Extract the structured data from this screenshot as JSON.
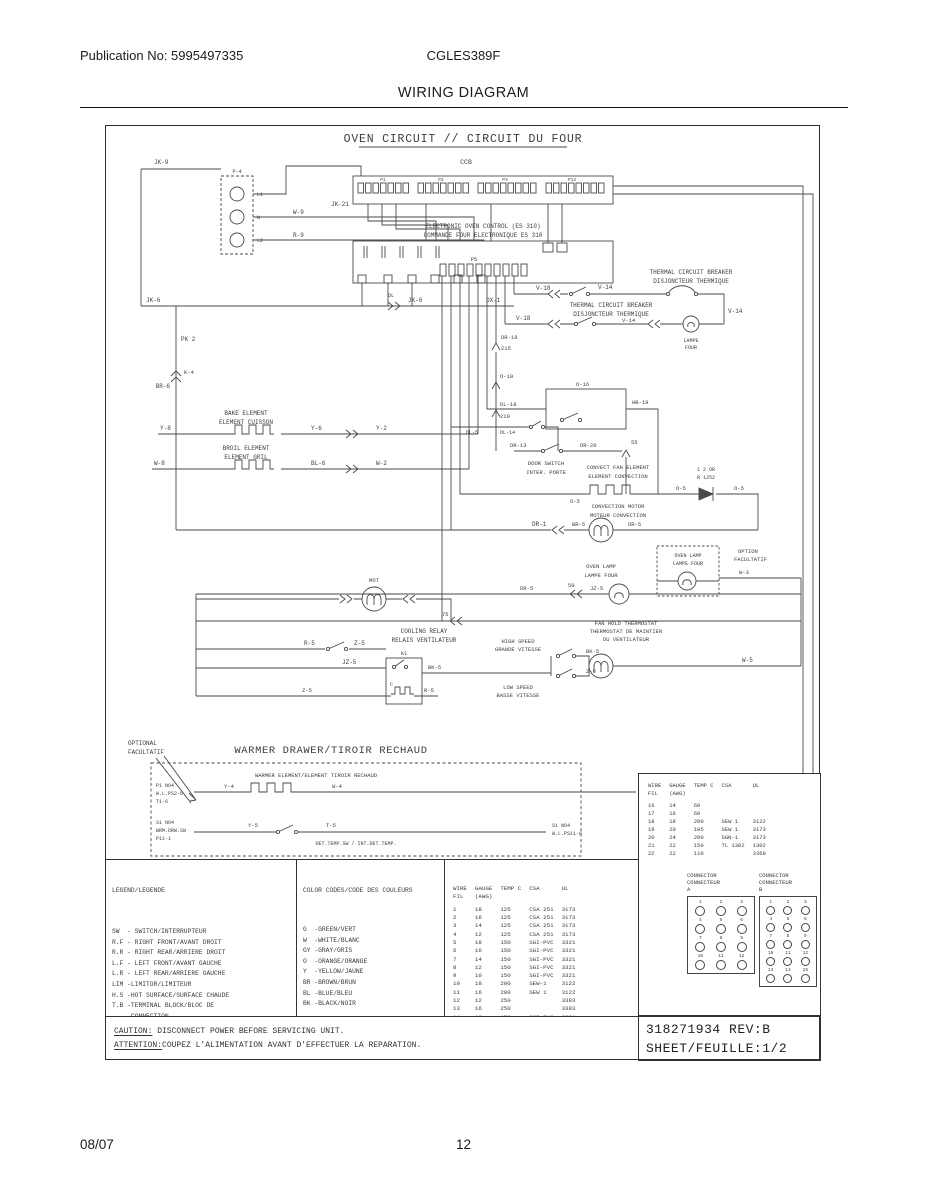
{
  "page": {
    "publication": "Publication No: 5995497335",
    "model": "CGLES389F",
    "title": "WIRING DIAGRAM",
    "date": "08/07",
    "page_number": "12"
  },
  "diagram": {
    "title": "OVEN CIRCUIT // CIRCUIT DU FOUR",
    "labels": {
      "jk9": "JK-9",
      "p4": "P-4",
      "l1": "L1",
      "n": "N",
      "l2": "L2",
      "w9": "W-9",
      "r9": "R-9",
      "ccb": "CCB",
      "jk21": "JK-21",
      "cp1": "P1",
      "cp2": "P2",
      "cp3": "P3",
      "cp12": "P12",
      "eoc1": "ELECTRONIC OVEN CONTROL (ES 310)",
      "eoc2": "COMMANDE FOUR ELECTRONIQUE ES 310",
      "p5": "P5",
      "dx1": "DX-1",
      "jk6a": "JK-6",
      "dl": "DL",
      "jk6b": "JK-6",
      "pk2": "PK 2",
      "k4": "K-4",
      "br6": "BR-6",
      "tcb1a": "THERMAL CIRCUIT BREAKER",
      "tcb1b": "DISJONCTEUR THERMIQUE",
      "tcb2a": "THERMAL CIRCUIT BREAKER",
      "tcb2b": "DISJONCTEUR THERMIQUE",
      "v18a": "V-18",
      "v14a": "V-14",
      "v14b": "V-14",
      "v18b": "V-18",
      "v14c": "V-14",
      "lampa1": "LAMPE",
      "lampa2": "FOUR",
      "dr18": "DR-18",
      "f215": "215",
      "o19": "O-19",
      "o16": "O-16",
      "hb19": "HB-19",
      "dl18": "DL-18",
      "f219": "219",
      "dl5": "DL-5",
      "dl14": "DL-14",
      "f55": "55",
      "dr13": "DR-13",
      "dr20": "DR-20",
      "door1": "DOOR SWITCH",
      "door2": "INTER. PORTE",
      "conv1": "CONVECT FAN ELEMENT",
      "conv2": "ELEMENT CONVECTION",
      "dio1": "1 2 OR",
      "dio2": "R 1252",
      "o5a": "O-5",
      "o5b": "O-5",
      "o5c": "O-5",
      "cm1": "CONVECTION MOTOR",
      "cm2": "MOTEUR CONVECTION",
      "dr1": "DR-1",
      "br5": "BR-5",
      "dr5a": "DR-5",
      "bake1": "BAKE ELEMENT",
      "bake2": "ELEMENT CUISSON",
      "y8": "Y-8",
      "y6": "Y-6",
      "y2": "Y-2",
      "broil1": "BROIL ELEMENT",
      "broil2": "ELEMENT GRIL",
      "w8": "W-8",
      "bl6": "BL-6",
      "w2": "W-2",
      "dr5b": "DR-5",
      "n50": "50",
      "jz5a": "JZ-5",
      "ol1": "OVEN LAMP",
      "ol2": "LAMPE FOUR",
      "opl1": "OVEN LAMP",
      "opl2": "LAMPE FOUR",
      "opt1": "OPTION",
      "opt2": "FACULTATIF",
      "w3": "W-3",
      "mot": "MOT",
      "n75": "75",
      "cr1": "COOLING RELAY",
      "cr2": "RELAIS VENTILATEUR",
      "r5a": "R-5",
      "z5a": "Z-5",
      "jz5b": "JZ-5",
      "k1": "K1",
      "cc": "C",
      "bk5a": "BK-5",
      "z5b": "Z-5",
      "r5b": "R-5",
      "fh1": "FAN HOLD THERMOSTAT",
      "fh2": "THERMOSTAT DE MAINTIEN",
      "fh3": "DU VENTILATEUR",
      "hs1": "HIGH SPEED",
      "hs2": "GRANDE VITESSE",
      "ls1": "LOW SPEED",
      "ls2": "BASSE VITESSE",
      "bk5b": "BK-5",
      "z5c": "Z-5",
      "w5": "W-5",
      "optn1": "OPTIONAL",
      "optn2": "FACULTATIF",
      "wtitle": "WARMER DRAWER/TIROIR RECHAUD",
      "wel": "WARMER ELEMENT/ELEMENT TIROIR RECHAUD",
      "wl1a": "P1 NO4",
      "wl1b": "W.L.PS2-6",
      "wl1c": "T1-6",
      "wy4": "Y-4",
      "ww4": "W-4",
      "wl2a": "S1 NO4",
      "wl2b": "WRM.DRW.SW",
      "wl2c": "P11-1",
      "y5": "Y-5",
      "t5w": "T-5",
      "wr1": "S1 NO4",
      "wr2": "W.L.PS11-6",
      "wnote": "DET.TEMP.SW / INT.DET.TEMP."
    },
    "legend": {
      "header": "LEGEND/LEGENDE",
      "lines": [
        "SW  - SWITCH/INTERRUPTEUR",
        "R.F - RIGHT FRONT/AVANT DROIT",
        "R.R - RIGHT REAR/ARRIERE DROIT",
        "L.F - LEFT FRONT/AVANT GAUCHE",
        "L.R - LEFT REAR/ARRIERE GAUCHE",
        "LIM -LIMITOR/LIMITEUR",
        "H.S -HOT SURFACE/SURFACE CHAUDE",
        "T.B -TERMINAL BLOCK/BLOC DE",
        "     CONNECTION",
        "CON -CONTROL/CONTROLE ESEC 15",
        "C.T -COOK TOP/TABLE DE CUISSON",
        "M.D.L-MOTOR DOOR LATCH/MOT.DU VERROU"
      ]
    },
    "colors": {
      "header": "COLOR CODES/CODE DES COULEURS",
      "lines": [
        "G  -GREEN/VERT",
        "W  -WHITE/BLANC",
        "GY -GRAY/GRIS",
        "O  -ORANGE/ORANGE",
        "Y  -YELLOW/JAUNE",
        "BR -BROWN/BRUN",
        "BL -BLUE/BLEU",
        "BK -BLACK/NOIR"
      ]
    },
    "wire_table": {
      "headers": [
        [
          "WIRE",
          "GAUGE",
          "TEMP C",
          "CSA",
          "UL"
        ],
        [
          "FIL",
          "(AWG)",
          "",
          "",
          ""
        ]
      ],
      "rows": [
        [
          "1",
          "18",
          "125",
          "CSA 251",
          "3173"
        ],
        [
          "2",
          "16",
          "125",
          "CSA 251",
          "3173"
        ],
        [
          "3",
          "14",
          "125",
          "CSA 251",
          "3173"
        ],
        [
          "4",
          "12",
          "125",
          "CSA 251",
          "3173"
        ],
        [
          "5",
          "18",
          "150",
          "SGI-PVC",
          "3321"
        ],
        [
          "6",
          "16",
          "150",
          "SGI-PVC",
          "3321"
        ],
        [
          "7",
          "14",
          "150",
          "SGI-PVC",
          "3321"
        ],
        [
          "8",
          "12",
          "150",
          "SGI-PVC",
          "3321"
        ],
        [
          "9",
          "10",
          "150",
          "SGI-PVC",
          "3321"
        ],
        [
          "10",
          "18",
          "200",
          "SEW-1",
          "3122"
        ],
        [
          "11",
          "16",
          "200",
          "SEW 1",
          "3122"
        ],
        [
          "12",
          "12",
          "250",
          "",
          "3383"
        ],
        [
          "13",
          "16",
          "250",
          "",
          "3383"
        ],
        [
          "14",
          "10",
          "150",
          "SGI-PVC",
          "3321"
        ],
        [
          "15",
          "8",
          "150",
          "SRL 251",
          "3321"
        ]
      ]
    },
    "panel_table": {
      "headers": [
        [
          "WIRE",
          "GAUGE",
          "TEMP C",
          "CSA",
          "UL"
        ],
        [
          "FIL",
          "(AWG)",
          "",
          "",
          ""
        ]
      ],
      "rows": [
        [
          "16",
          "14",
          "60",
          "",
          ""
        ],
        [
          "17",
          "16",
          "60",
          "",
          ""
        ],
        [
          "18",
          "18",
          "200",
          "SEW 1",
          "3122"
        ],
        [
          "19",
          "20",
          "105",
          "SEW 1",
          "3173"
        ],
        [
          "20",
          "24",
          "200",
          "SGN-1",
          "3173"
        ],
        [
          "21",
          "22",
          "150",
          "TL 1302",
          "1302"
        ],
        [
          "22",
          "22",
          "110",
          "",
          "3369"
        ]
      ]
    },
    "connectors": {
      "a": {
        "line1": "CONNECTOR",
        "line2": "CONNECTEUR",
        "line3": "A",
        "count": 12
      },
      "b": {
        "line1": "CONNECTOR",
        "line2": "CONNECTEUR",
        "line3": "B",
        "count": 15
      }
    },
    "caution": {
      "c_label": "CAUTION:",
      "c_text": " DISCONNECT POWER BEFORE SERVICING UNIT.",
      "a_label": "ATTENTION:",
      "a_text": "COUPEZ L'ALIMENTATION AVANT D'EFFECTUER LA REPARATION."
    },
    "ref": {
      "part": "318271934 REV:B",
      "sheet": "SHEET/FEUILLE:1/2"
    }
  }
}
